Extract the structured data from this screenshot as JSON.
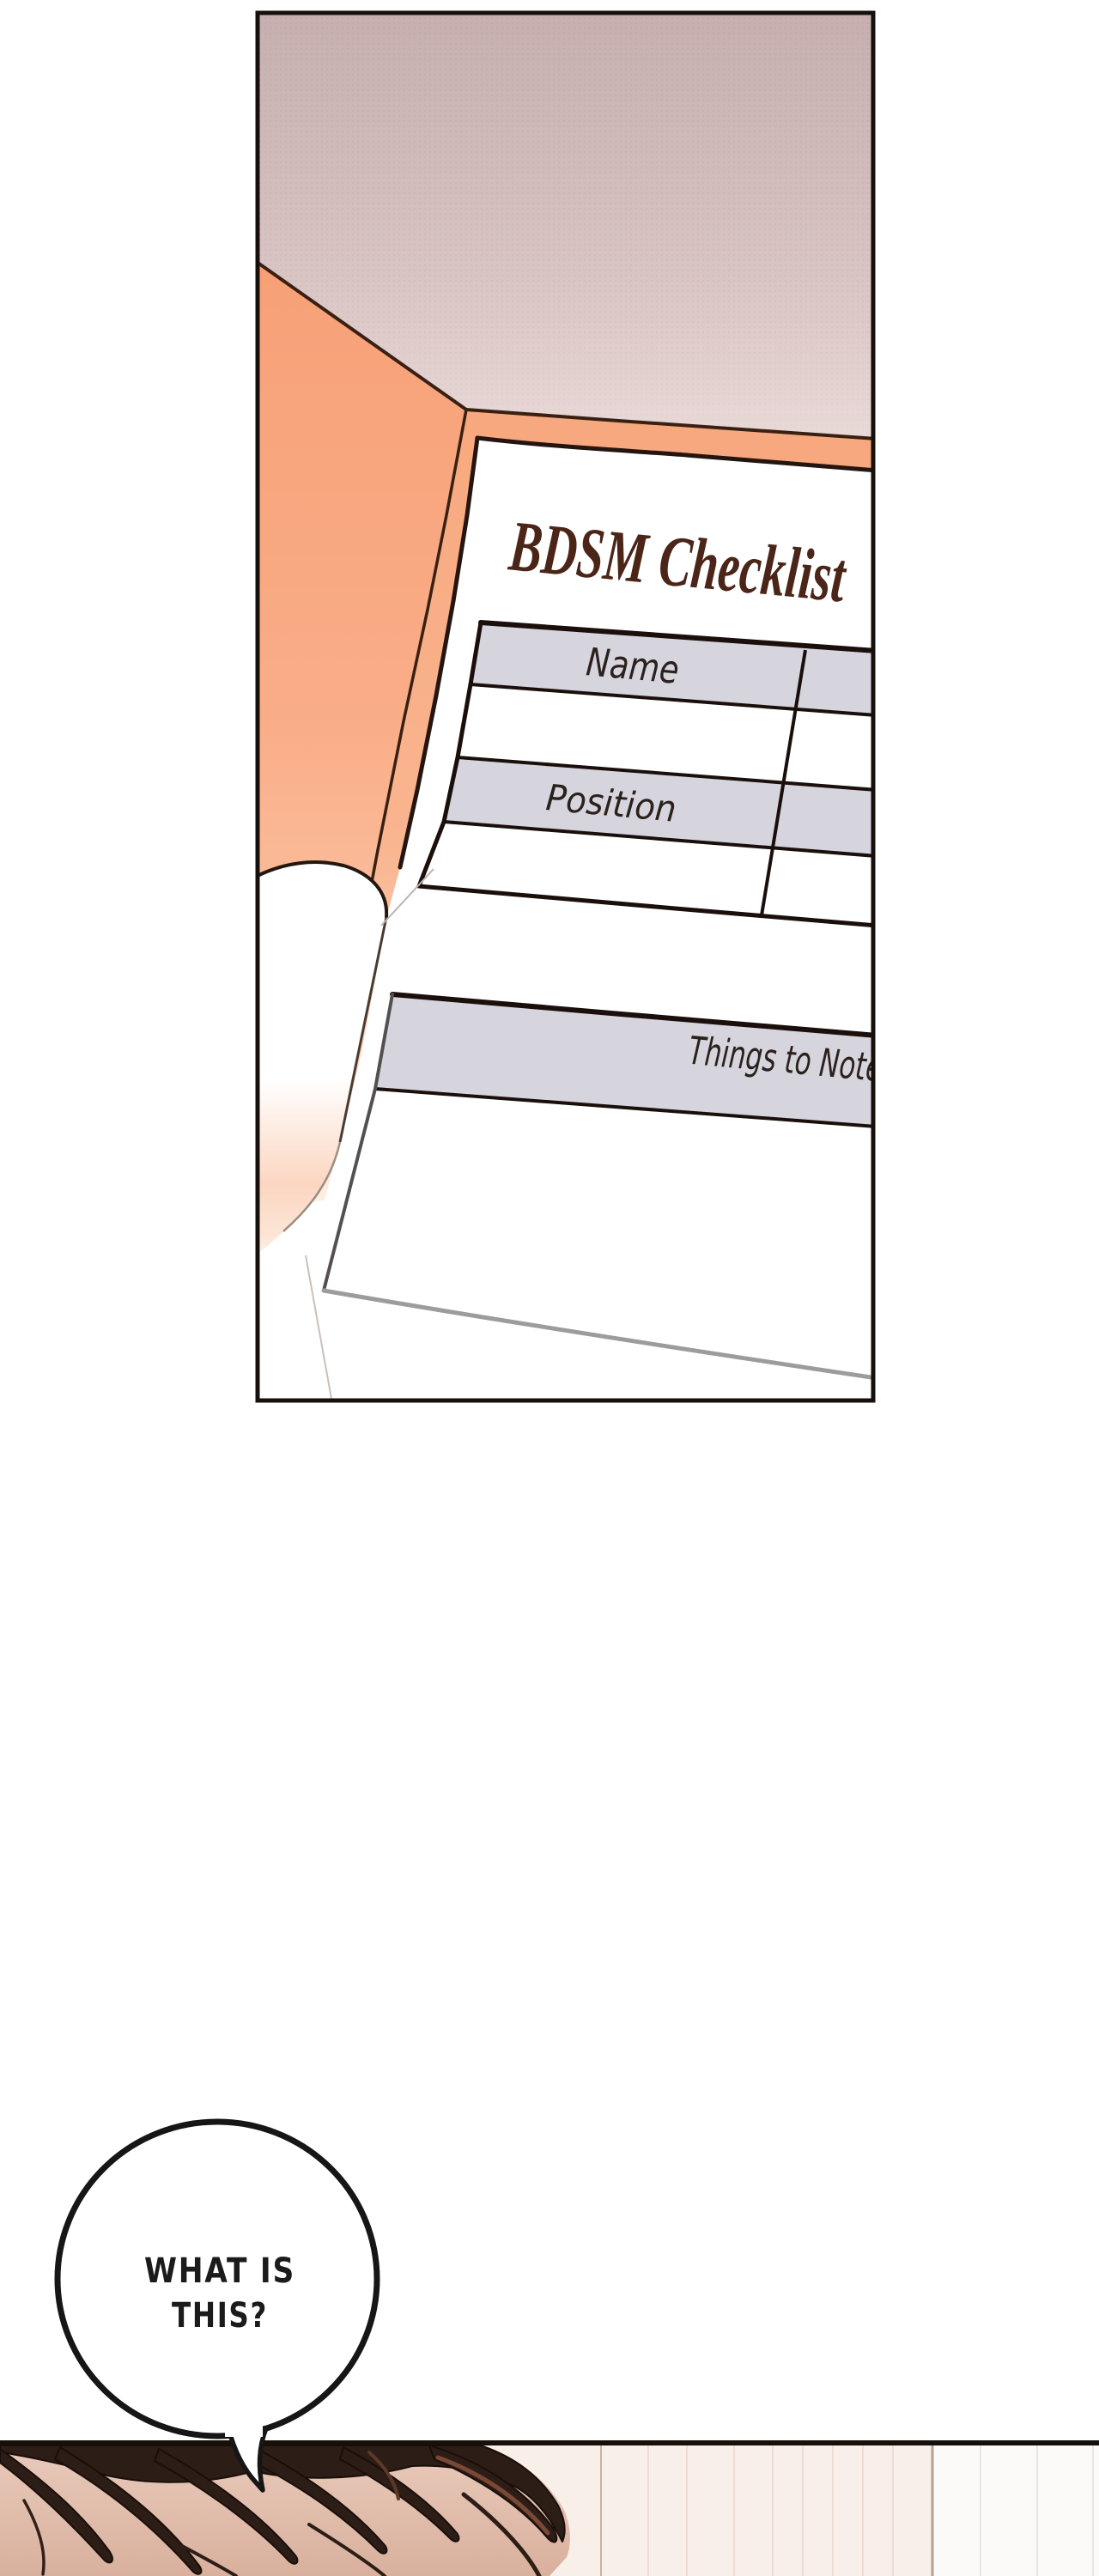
{
  "comic": {
    "panel_document": {
      "title": "BDSM Checklist",
      "row_label_1": "Name",
      "row_label_2": "Position",
      "section_label": "Things to Note"
    },
    "speech_bubble": {
      "line_1": "WHAT IS",
      "line_2": "THIS?"
    },
    "colors": {
      "folder_orange": "#f8a87e",
      "table_header_gray": "#d6d4dd",
      "title_brown": "#4a2518",
      "halftone_mauve": "#c7afaf",
      "hair_brown": "#2d1d17",
      "skin_tone": "#dfb9a7",
      "wall_cream": "#f8efe9",
      "panel_border_black": "#15100c"
    }
  }
}
